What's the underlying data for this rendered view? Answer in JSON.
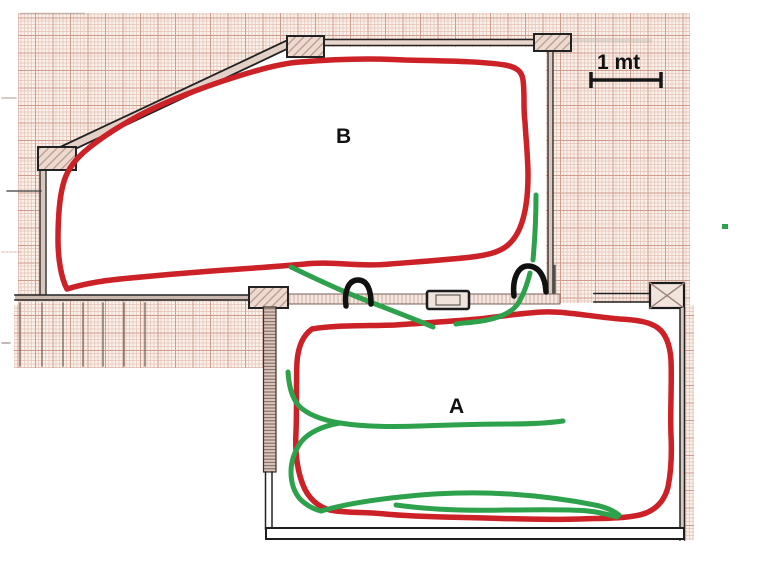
{
  "page": {
    "width": 763,
    "height": 586,
    "background": "#ffffff"
  },
  "diagram": {
    "kind": "hand-annotated architectural floor plan on graph paper",
    "rooms": [
      {
        "id": "room-b",
        "label": "B"
      },
      {
        "id": "room-a",
        "label": "A"
      }
    ],
    "scale_bar": {
      "label": "1 mt"
    },
    "routes": [
      {
        "name": "red-route-room-b",
        "color": "#cb2127",
        "description": "closed red loop traced inside room B"
      },
      {
        "name": "red-route-room-a",
        "color": "#cb2127",
        "description": "closed red loop traced inside room A"
      },
      {
        "name": "green-route",
        "color": "#2da14b",
        "description": "green connector paths through doorways and inside room A"
      }
    ],
    "door_arcs": {
      "color": "#111111",
      "count": 2
    },
    "grid": {
      "bg": "#f9f1ec",
      "minor": "#e6c3b5",
      "major": "#cf9c8b"
    },
    "wall_color": "#1c1c1c",
    "marker_dot": {
      "color": "#2da14b"
    }
  }
}
